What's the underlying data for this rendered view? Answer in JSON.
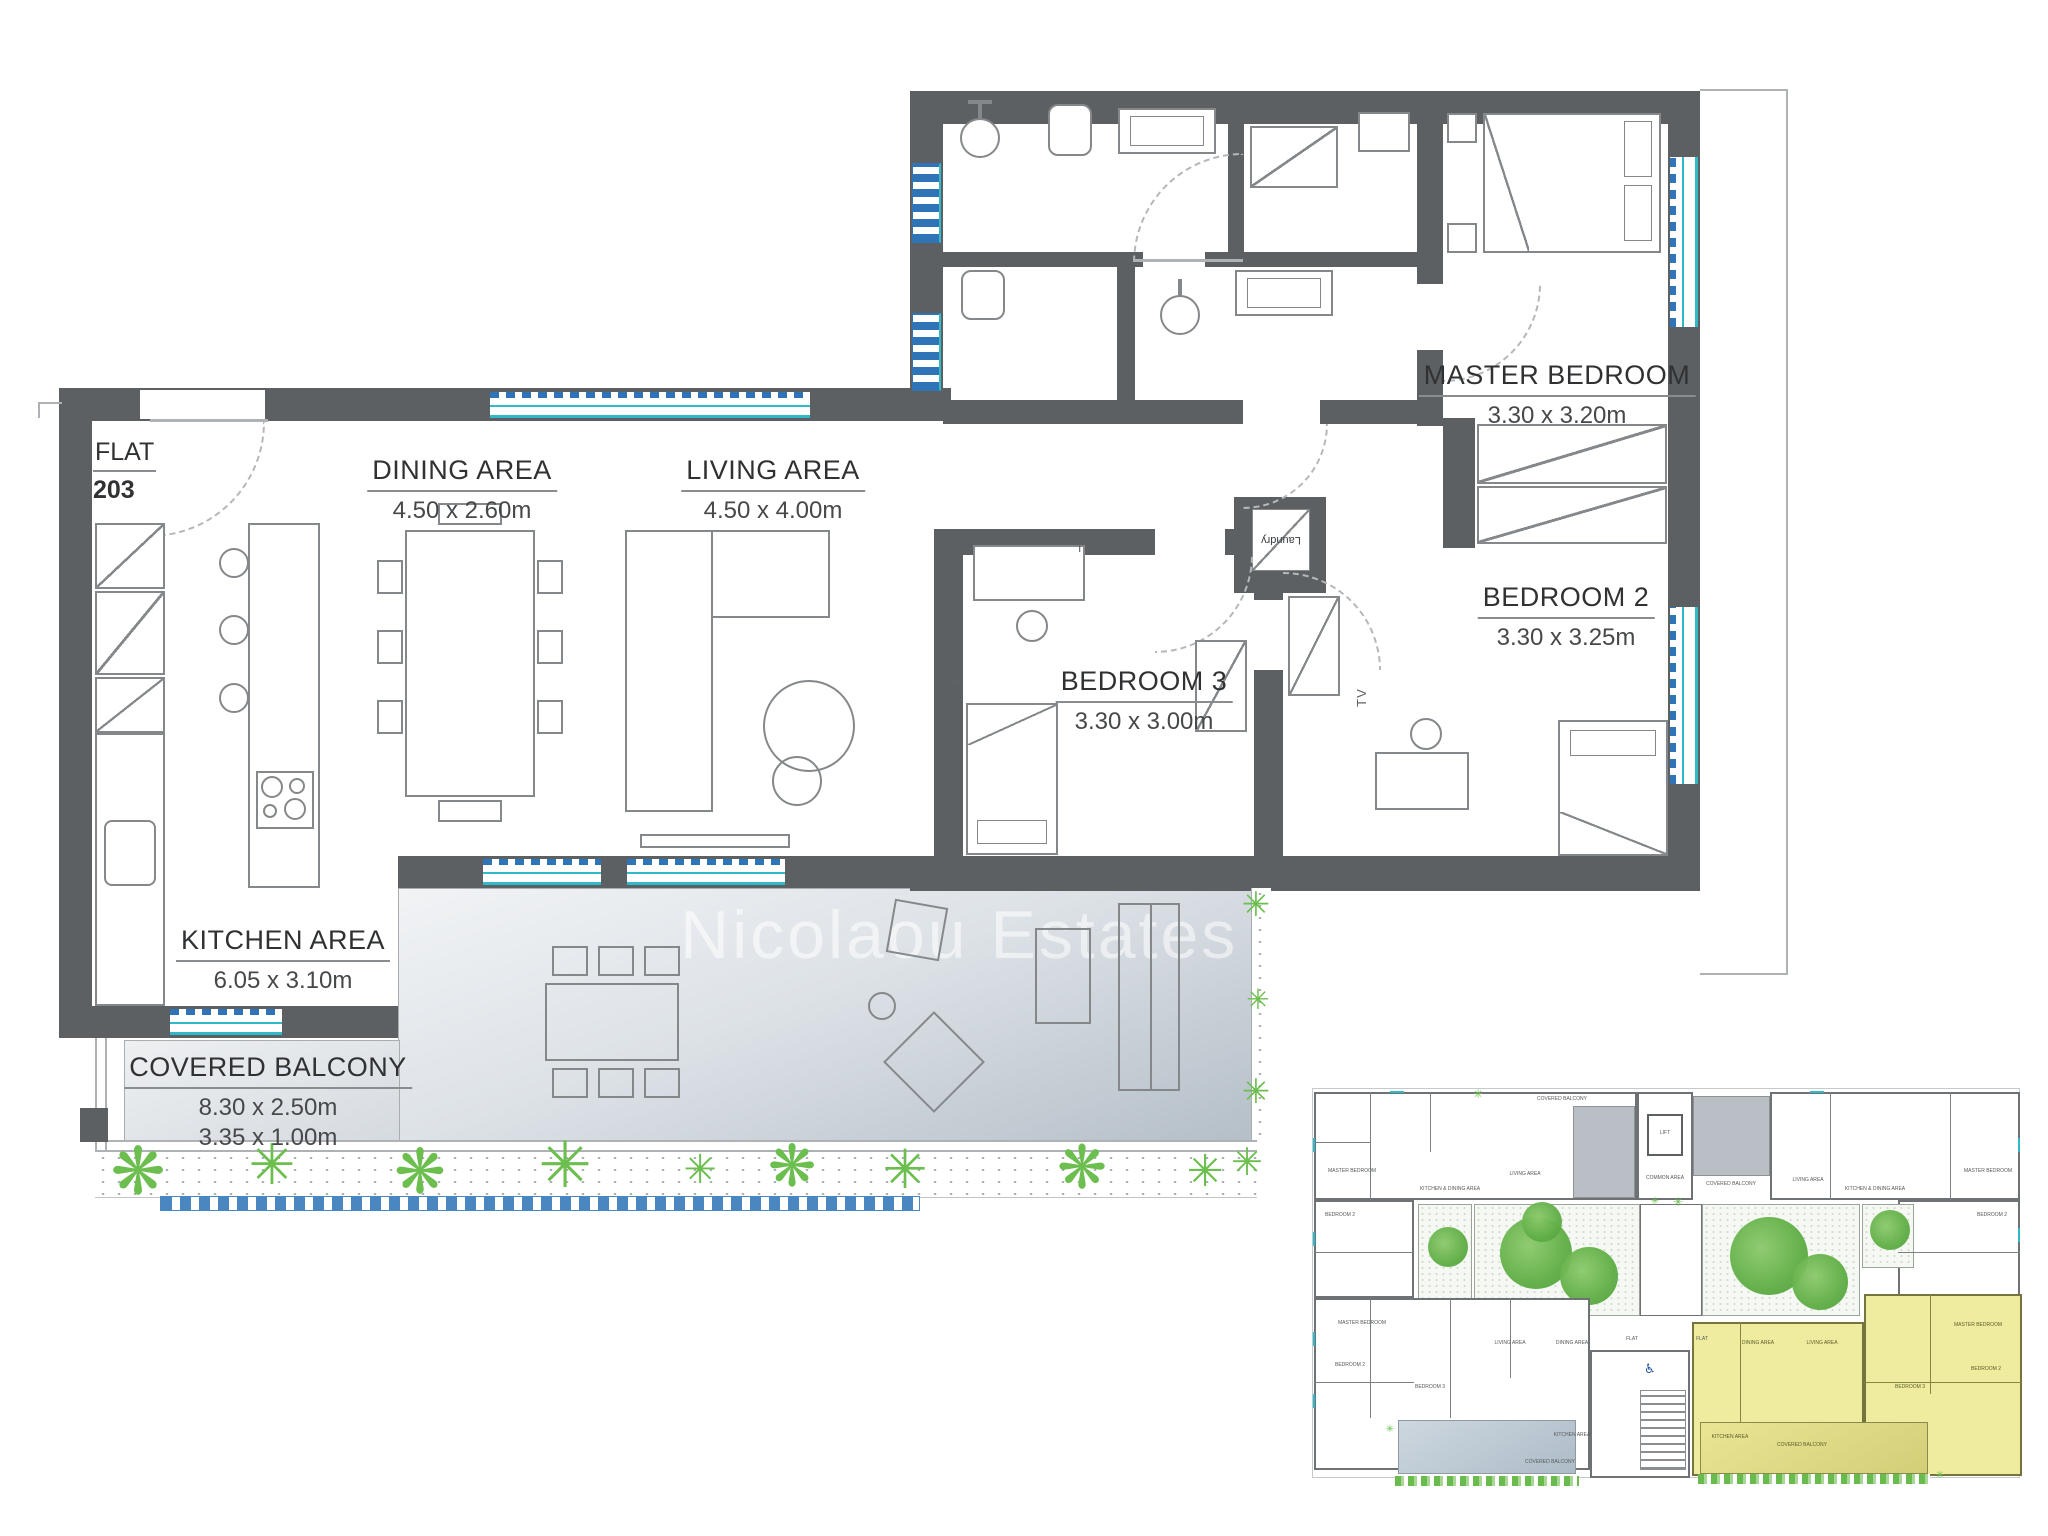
{
  "flat": {
    "label": "FLAT",
    "number": "203"
  },
  "rooms": [
    {
      "name": "DINING AREA",
      "dims": "4.50 x 2.60m"
    },
    {
      "name": "LIVING AREA",
      "dims": "4.50 x 4.00m"
    },
    {
      "name": "MASTER BEDROOM",
      "dims": "3.30 x 3.20m"
    },
    {
      "name": "BEDROOM 2",
      "dims": "3.30 x 3.25m"
    },
    {
      "name": "BEDROOM 3",
      "dims": "3.30 x 3.00m"
    },
    {
      "name": "KITCHEN AREA",
      "dims": "6.05 x 3.10m"
    },
    {
      "name": "COVERED BALCONY",
      "dims": "8.30 x 2.50m",
      "dims2": "3.35 x 1.00m"
    }
  ],
  "annotations": {
    "laundry": "Laundry",
    "tv": "TV"
  },
  "watermark": "Nicolaou Estates",
  "icons": {
    "plant": "✳",
    "plant_round": "❋",
    "wheelchair": "♿"
  },
  "colors": {
    "wall": "#5d6063",
    "furniture_outline": "#85888b",
    "window_teal": "#2fb9c9",
    "window_blue": "#2e74b6",
    "plant_green": "#6cbf4e",
    "balcony_gray": "#b5bfc8",
    "keyplan_highlight": "#efec9f",
    "keyplan_balcony_gray": "#b9bfc5",
    "keyplan_balcony_blue": "#b9c6d2",
    "wheelchair_blue": "#2050a0"
  },
  "key_plan": {
    "labels": [
      "COVERED BALCONY",
      "LIFT",
      "COMMON AREA",
      "COVERED BALCONY",
      "MASTER BEDROOM",
      "LIVING AREA",
      "KITCHEN & DINING AREA",
      "BEDROOM 2",
      "LIVING AREA",
      "KITCHEN & DINING AREA",
      "MASTER BEDROOM",
      "BEDROOM 2",
      "MASTER BEDROOM",
      "BEDROOM 2",
      "BEDROOM 3",
      "LIVING AREA",
      "DINING AREA",
      "KITCHEN AREA",
      "COVERED BALCONY",
      "FLAT",
      "FLAT",
      "DINING AREA",
      "LIVING AREA",
      "KITCHEN AREA",
      "BEDROOM 3",
      "MASTER BEDROOM",
      "BEDROOM 2",
      "COVERED BALCONY"
    ]
  }
}
